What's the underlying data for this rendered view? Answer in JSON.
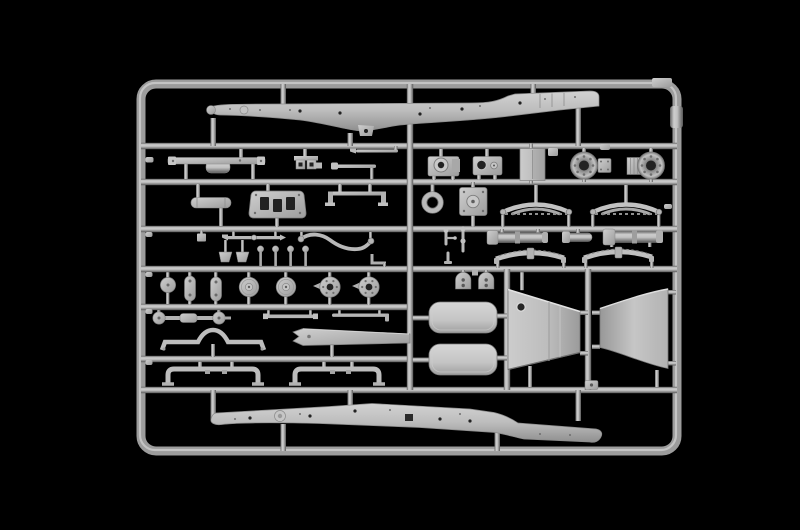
{
  "image": {
    "type": "product-photo",
    "alt": "Light grey injection-molded plastic model kit sprue (parts tree) photographed on a black background. A rounded rectangular outer frame holds seven horizontal runner bars filled with unpainted truck parts: two long chassis side rails at top and bottom, axle hubs, gearbox housings, a radiator core, leaf springs, axle housings, brake drums and hub flanges, steering rods, a muffler, a firewall plate, two seat cushions, two large trapezoidal hood side panels, a running board, a fender blade and two U-shaped bumper frames."
  },
  "colors": {
    "background": "#000000",
    "plastic_base": "#b4b4b4",
    "plastic_highlight": "#dcdcdc",
    "plastic_shadow": "#7a7a7a",
    "hole": "#222222"
  },
  "sprue": {
    "material": "light grey polystyrene",
    "structure": {
      "outer_frame": "rounded rectangle",
      "horizontal_runners": 7,
      "vertical_runners": 3,
      "frame_tab": "small mold tab at top-right corner"
    },
    "parts": [
      {
        "name": "chassis-rail-top",
        "qty": 1
      },
      {
        "name": "chassis-rail-bottom",
        "qty": 1
      },
      {
        "name": "storage-rack-rail-with-tank",
        "qty": 1
      },
      {
        "name": "engine-mount-bracket",
        "qty": 1
      },
      {
        "name": "tie-rods-upper",
        "qty": 2
      },
      {
        "name": "gearbox-housing",
        "qty": 1
      },
      {
        "name": "transfer-case",
        "qty": 1
      },
      {
        "name": "radiator-core",
        "qty": 1
      },
      {
        "name": "wheel-hub",
        "qty": 2
      },
      {
        "name": "axle-coupler",
        "qty": 1
      },
      {
        "name": "muffler",
        "qty": 1
      },
      {
        "name": "firewall-plate",
        "qty": 1
      },
      {
        "name": "step-rail",
        "qty": 1
      },
      {
        "name": "sealing-ring",
        "qty": 1
      },
      {
        "name": "mounting-plate",
        "qty": 1
      },
      {
        "name": "leaf-spring-front",
        "qty": 2
      },
      {
        "name": "leaf-spring-rear",
        "qty": 2
      },
      {
        "name": "steering-tie-rod",
        "qty": 1
      },
      {
        "name": "sway-bar",
        "qty": 1
      },
      {
        "name": "gear-lever",
        "qty": 3
      },
      {
        "name": "pin",
        "qty": 4
      },
      {
        "name": "pedal-wedge",
        "qty": 2
      },
      {
        "name": "axle-housing",
        "qty": 3
      },
      {
        "name": "idler-wheel",
        "qty": 1
      },
      {
        "name": "roller-capsule",
        "qty": 2
      },
      {
        "name": "brake-drum",
        "qty": 2
      },
      {
        "name": "hub-flange",
        "qty": 2
      },
      {
        "name": "spring-shackle",
        "qty": 2
      },
      {
        "name": "seat-cushion",
        "qty": 2
      },
      {
        "name": "hood-side-panel",
        "qty": 2
      },
      {
        "name": "front-axle-shaft",
        "qty": 1
      },
      {
        "name": "drive-shaft",
        "qty": 1
      },
      {
        "name": "brake-rod",
        "qty": 1
      },
      {
        "name": "running-board",
        "qty": 1
      },
      {
        "name": "fender-blade",
        "qty": 1
      },
      {
        "name": "bumper-frame",
        "qty": 2
      },
      {
        "name": "latch-bracket",
        "qty": 1
      }
    ]
  }
}
